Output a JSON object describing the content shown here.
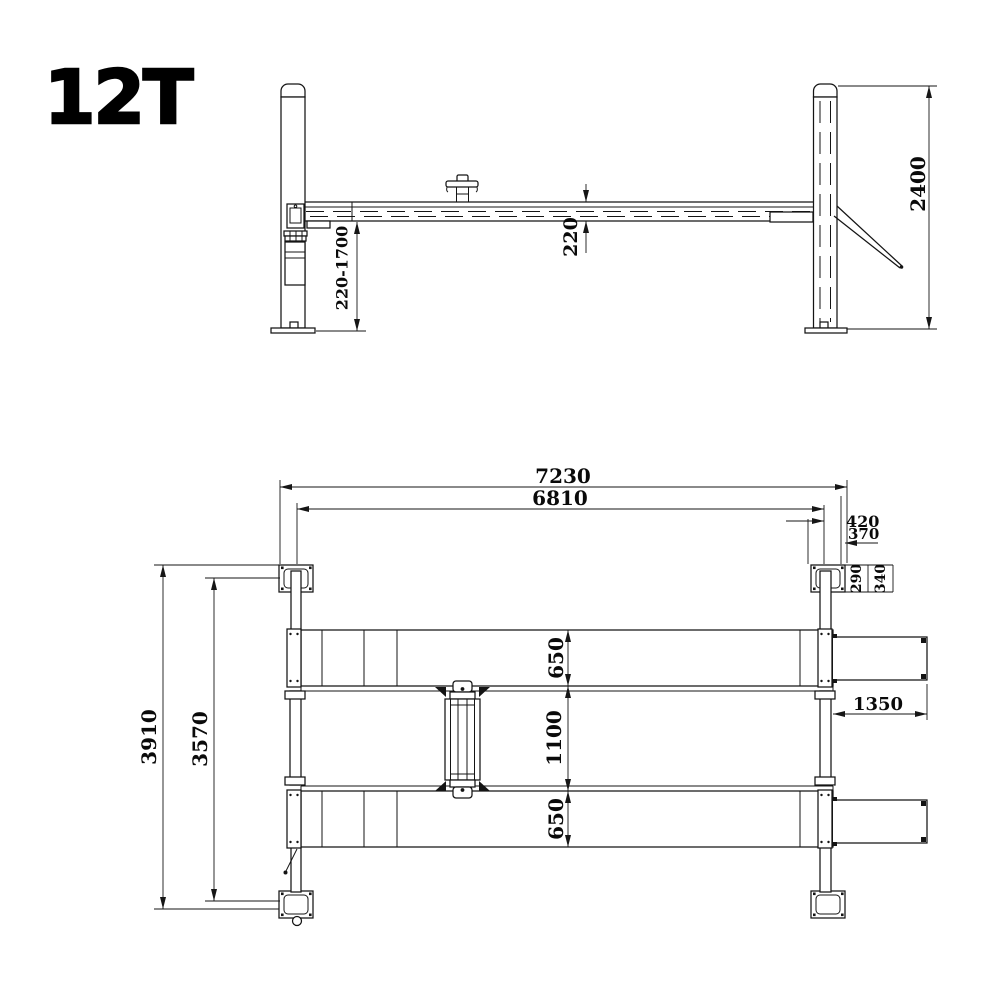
{
  "title": "12T",
  "colors": {
    "line": "#141414",
    "background": "#ffffff"
  },
  "side_view": {
    "dim_lift_height_range": "220-1700",
    "dim_runway_thickness": "220",
    "dim_column_height": "2400"
  },
  "plan_view": {
    "dim_overall_length": "7230",
    "dim_inner_length": "6810",
    "dim_420": "420",
    "dim_370": "370",
    "dim_290": "290",
    "dim_340": "340",
    "dim_runway_width_front": "650",
    "dim_runway_gap": "1100",
    "dim_runway_width_rear": "650",
    "dim_ramp_length": "1350",
    "dim_overall_width": "3910",
    "dim_inner_width": "3570"
  }
}
